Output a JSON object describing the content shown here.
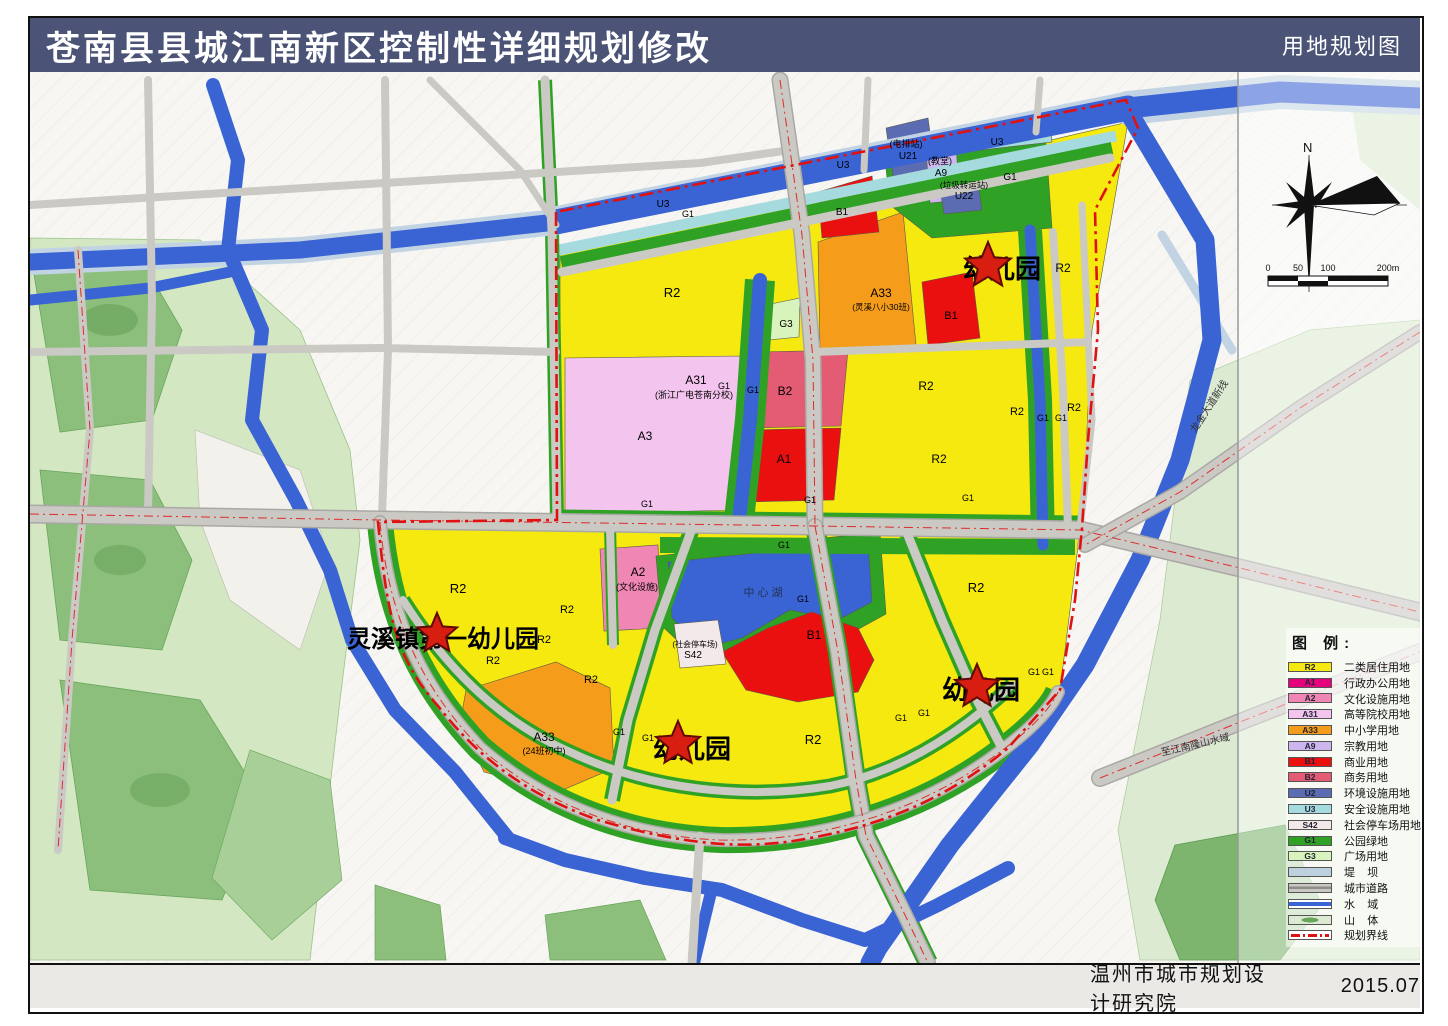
{
  "title_bar": {
    "title": "苍南县县城江南新区控制性详细规划修改",
    "map_type": "用地规划图",
    "bg_color": "#4b5477"
  },
  "footer": {
    "institute": "温州市城市规划设计研究院",
    "date": "2015.07"
  },
  "compass": {
    "north_label": "N"
  },
  "scalebar": {
    "ticks": [
      "0",
      "50",
      "100",
      "200m"
    ]
  },
  "legend": {
    "title": "图  例:",
    "items": [
      {
        "code": "R2",
        "label": "二类居住用地",
        "color": "#f5e90f"
      },
      {
        "code": "A1",
        "label": "行政办公用地",
        "color": "#e5007e"
      },
      {
        "code": "A2",
        "label": "文化设施用地",
        "color": "#ef86b4"
      },
      {
        "code": "A31",
        "label": "高等院校用地",
        "color": "#f2c4ee"
      },
      {
        "code": "A33",
        "label": "中小学用地",
        "color": "#f59d1a"
      },
      {
        "code": "A9",
        "label": "宗教用地",
        "color": "#cdb6ee"
      },
      {
        "code": "B1",
        "label": "商业用地",
        "color": "#ea1010"
      },
      {
        "code": "B2",
        "label": "商务用地",
        "color": "#e45b74"
      },
      {
        "code": "U2",
        "label": "环境设施用地",
        "color": "#5b6cb2"
      },
      {
        "code": "U3",
        "label": "安全设施用地",
        "color": "#a5dade"
      },
      {
        "code": "S42",
        "label": "社会停车场用地",
        "color": "#f3e9ea"
      },
      {
        "code": "G1",
        "label": "公园绿地",
        "color": "#2fa226"
      },
      {
        "code": "G3",
        "label": "广场用地",
        "color": "#d9f3bd"
      },
      {
        "code": "",
        "label": "堤    坝",
        "color": "#bdd0de",
        "symbol": "dam"
      },
      {
        "code": "",
        "label": "城市道路",
        "color": "",
        "symbol": "road"
      },
      {
        "code": "",
        "label": "水    域",
        "color": "",
        "symbol": "water"
      },
      {
        "code": "",
        "label": "山    体",
        "color": "",
        "symbol": "mountain"
      },
      {
        "code": "",
        "label": "规划界线",
        "color": "",
        "symbol": "boundary"
      }
    ]
  },
  "stars": [
    {
      "x": 988,
      "y": 266,
      "r": 24
    },
    {
      "x": 437,
      "y": 634,
      "r": 21
    },
    {
      "x": 678,
      "y": 744,
      "r": 23
    },
    {
      "x": 977,
      "y": 687,
      "r": 23
    }
  ],
  "map_labels": [
    {
      "t": "U3",
      "x": 663,
      "y": 207,
      "s": 10
    },
    {
      "t": "G1",
      "x": 688,
      "y": 217,
      "s": 9
    },
    {
      "t": "U3",
      "x": 843,
      "y": 168,
      "s": 10
    },
    {
      "t": "(电排站)",
      "x": 906,
      "y": 147,
      "s": 9
    },
    {
      "t": "U21",
      "x": 908,
      "y": 159,
      "s": 10
    },
    {
      "t": "(教堂)",
      "x": 940,
      "y": 164,
      "s": 9
    },
    {
      "t": "A9",
      "x": 941,
      "y": 176,
      "s": 10
    },
    {
      "t": "(垃圾转运站)",
      "x": 964,
      "y": 188,
      "s": 8.5
    },
    {
      "t": "U22",
      "x": 964,
      "y": 199,
      "s": 10
    },
    {
      "t": "G1",
      "x": 1010,
      "y": 180,
      "s": 10
    },
    {
      "t": "U3",
      "x": 997,
      "y": 145,
      "s": 10
    },
    {
      "t": "R2",
      "x": 672,
      "y": 297,
      "s": 13
    },
    {
      "t": "A31",
      "x": 696,
      "y": 384,
      "s": 12
    },
    {
      "t": "(浙江广电苍南分校)",
      "x": 694,
      "y": 398,
      "s": 9
    },
    {
      "t": "A3",
      "x": 645,
      "y": 440,
      "s": 12
    },
    {
      "t": "G3",
      "x": 786,
      "y": 327,
      "s": 10
    },
    {
      "t": "B2",
      "x": 785,
      "y": 395,
      "s": 12
    },
    {
      "t": "A1",
      "x": 784,
      "y": 463,
      "s": 12
    },
    {
      "t": "A33",
      "x": 881,
      "y": 297,
      "s": 12
    },
    {
      "t": "(灵溪八小30班)",
      "x": 881,
      "y": 310,
      "s": 8.5
    },
    {
      "t": "B1",
      "x": 951,
      "y": 319,
      "s": 11
    },
    {
      "t": "B1",
      "x": 842,
      "y": 215,
      "s": 10
    },
    {
      "t": "R2",
      "x": 1063,
      "y": 272,
      "s": 12
    },
    {
      "t": "R2",
      "x": 926,
      "y": 390,
      "s": 12
    },
    {
      "t": "R2",
      "x": 939,
      "y": 463,
      "s": 12
    },
    {
      "t": "R2",
      "x": 1017,
      "y": 415,
      "s": 11
    },
    {
      "t": "R2",
      "x": 1074,
      "y": 411,
      "s": 11
    },
    {
      "t": "G1",
      "x": 724,
      "y": 389,
      "s": 9
    },
    {
      "t": "G1",
      "x": 753,
      "y": 393,
      "s": 9
    },
    {
      "t": "G1",
      "x": 1043,
      "y": 421,
      "s": 9
    },
    {
      "t": "G1",
      "x": 1061,
      "y": 421,
      "s": 9
    },
    {
      "t": "G1",
      "x": 968,
      "y": 501,
      "s": 9
    },
    {
      "t": "G1",
      "x": 647,
      "y": 507,
      "s": 9
    },
    {
      "t": "G1",
      "x": 810,
      "y": 503,
      "s": 9
    },
    {
      "t": "A2",
      "x": 638,
      "y": 576,
      "s": 12
    },
    {
      "t": "(文化设施)",
      "x": 637,
      "y": 590,
      "s": 9
    },
    {
      "t": "中 心 湖",
      "x": 763,
      "y": 596,
      "s": 11,
      "c": "#223355"
    },
    {
      "t": "G1",
      "x": 784,
      "y": 548,
      "s": 9
    },
    {
      "t": "G1",
      "x": 803,
      "y": 602,
      "s": 9
    },
    {
      "t": "(社会停车场)",
      "x": 695,
      "y": 647,
      "s": 8
    },
    {
      "t": "S42",
      "x": 693,
      "y": 658,
      "s": 10
    },
    {
      "t": "B1",
      "x": 814,
      "y": 639,
      "s": 12
    },
    {
      "t": "R2",
      "x": 458,
      "y": 593,
      "s": 13
    },
    {
      "t": "R2",
      "x": 567,
      "y": 613,
      "s": 11
    },
    {
      "t": "R2",
      "x": 544,
      "y": 643,
      "s": 11
    },
    {
      "t": "R2",
      "x": 493,
      "y": 664,
      "s": 11
    },
    {
      "t": "R2",
      "x": 591,
      "y": 683,
      "s": 11
    },
    {
      "t": "A33",
      "x": 544,
      "y": 741,
      "s": 12
    },
    {
      "t": "(24班初中)",
      "x": 544,
      "y": 754,
      "s": 9
    },
    {
      "t": "R2",
      "x": 813,
      "y": 744,
      "s": 13
    },
    {
      "t": "R2",
      "x": 976,
      "y": 592,
      "s": 13
    },
    {
      "t": "G1",
      "x": 619,
      "y": 735,
      "s": 9
    },
    {
      "t": "G1",
      "x": 648,
      "y": 741,
      "s": 9
    },
    {
      "t": "G1",
      "x": 901,
      "y": 721,
      "s": 9
    },
    {
      "t": "G1",
      "x": 924,
      "y": 716,
      "s": 9
    },
    {
      "t": "G1",
      "x": 1034,
      "y": 675,
      "s": 9
    },
    {
      "t": "G1",
      "x": 1048,
      "y": 675,
      "s": 9
    },
    {
      "t": "幼儿园",
      "x": 1002,
      "y": 278,
      "s": 26,
      "b": true
    },
    {
      "t": "灵溪镇第一幼儿园",
      "x": 443,
      "y": 647,
      "s": 24,
      "b": true
    },
    {
      "t": "幼儿园",
      "x": 692,
      "y": 758,
      "s": 26,
      "b": true
    },
    {
      "t": "幼儿园",
      "x": 981,
      "y": 699,
      "s": 26,
      "b": true
    },
    {
      "t": "龙金大道新线",
      "x": 1212,
      "y": 408,
      "s": 10,
      "r": -57,
      "c": "#333333"
    },
    {
      "t": "至江南隆山水域",
      "x": 1196,
      "y": 748,
      "s": 10,
      "r": -13,
      "c": "#333333"
    }
  ]
}
